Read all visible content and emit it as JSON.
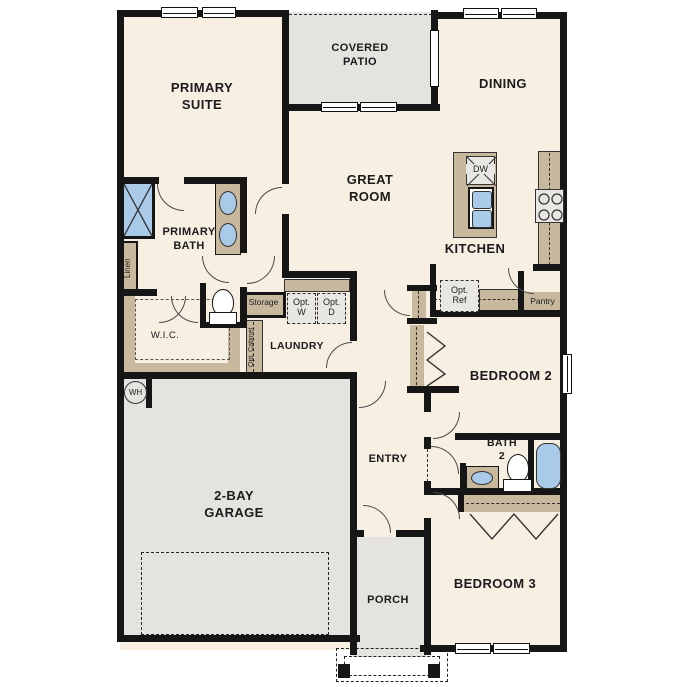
{
  "plan_type": "single-story residential floor plan",
  "colors": {
    "wall": "#161616",
    "interior_floor": "#f7efe2",
    "outdoor_floor": "#e4e3e0",
    "cabinet_tan": "#c8b89d",
    "fixture_blue": "#a9cae8"
  },
  "rooms": {
    "primary_suite": "PRIMARY\nSUITE",
    "covered_patio": "COVERED\nPATIO",
    "dining": "DINING",
    "great_room": "GREAT\nROOM",
    "kitchen": "KITCHEN",
    "primary_bath": "PRIMARY\nBATH",
    "wic": "W.I.C.",
    "laundry": "LAUNDRY",
    "entry": "ENTRY",
    "garage": "2-BAY\nGARAGE",
    "porch": "PORCH",
    "bedroom2": "BEDROOM 2",
    "bath2": "BATH\n2",
    "bedroom3": "BEDROOM 3"
  },
  "features": {
    "linen": "Linen",
    "storage": "Storage",
    "opt_cabinet": "Opt. Cabinet",
    "opt_washer": "Opt.\nW",
    "opt_dryer": "Opt.\nD",
    "opt_ref": "Opt.\nRef",
    "pantry": "Pantry",
    "dishwasher": "DW",
    "water_heater": "WH"
  }
}
